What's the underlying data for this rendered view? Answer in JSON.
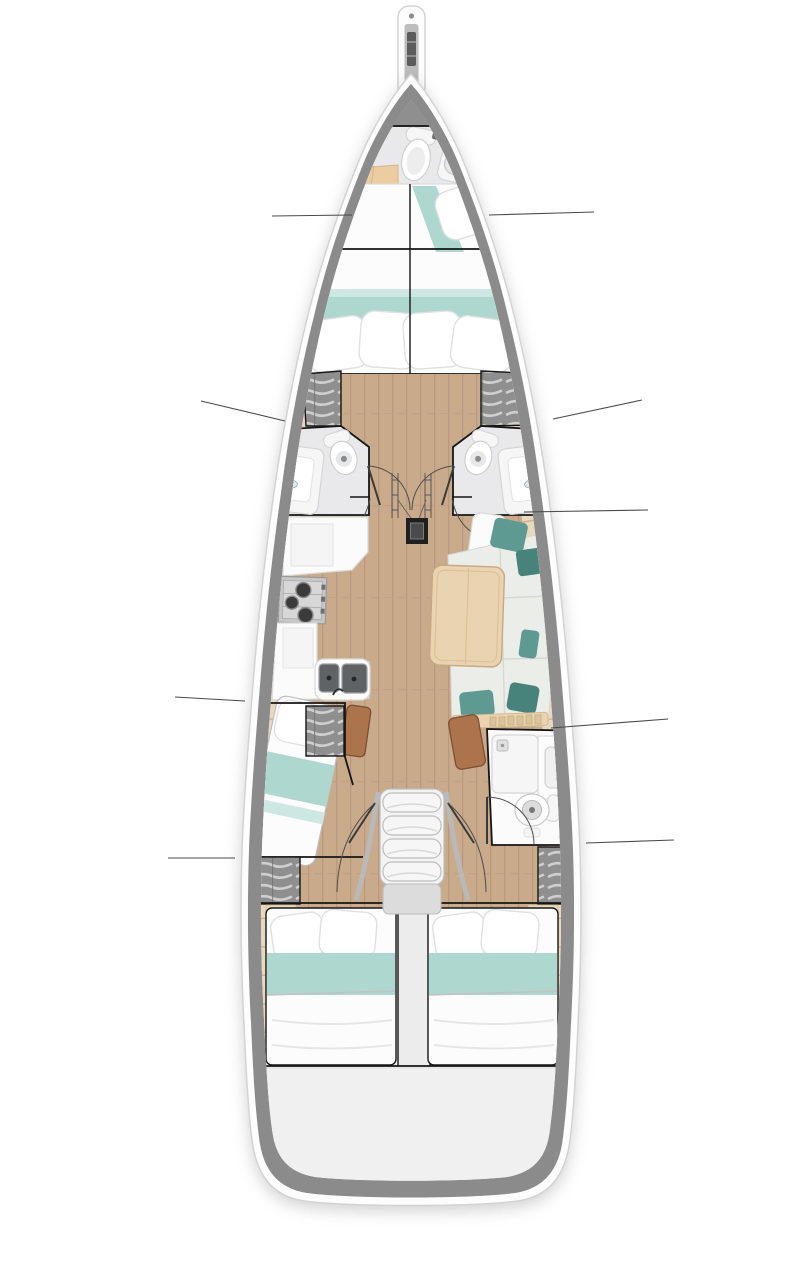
{
  "page": {
    "title": "Sailing yacht interior layout plan, bow up"
  },
  "diagram": {
    "type": "yacht-interior-floor-plan",
    "view": "top-down plan",
    "orientation": "bow at top, stern at bottom",
    "visible_text": "none"
  },
  "colors": {
    "background": "#ffffff",
    "hull_white": "#fdfdfd",
    "hull_edge": "#d3d3d3",
    "gunwale_grey": "#8b8b8b",
    "deck_grey": "#9b9b9b",
    "interior_base": "#f1f1f0",
    "floor_wood": "#c9aa8b",
    "floor_wood_dark": "#b6957a",
    "side_deck": "#e9d9bc",
    "side_deck_seam": "#cdb48e",
    "outline_black": "#161616",
    "leader_grey": "#4a4a4a",
    "bed_white": "#fcfcfc",
    "bed_shadow": "#e4e4e4",
    "blanket_teal": "#aed7d0",
    "blanket_teal_light": "#cde8e3",
    "pillow_white": "#ffffff",
    "pillow_edge": "#e0e0e0",
    "cushion_grey": "#ebede9",
    "cushion_seam": "#d6d8d3",
    "pillow_teal": "#5f9a92",
    "pillow_teal_dark": "#47837b",
    "table_wood": "#ead3b0",
    "table_edge": "#c9a87e",
    "counter_white": "#fbfbfb",
    "counter_edge": "#d9d9d9",
    "steel_grey": "#c7c7c7",
    "basin_dark": "#5f6366",
    "locker_grey": "#8f8f8f",
    "locker_stripe": "#d6d6d6",
    "fixture_white": "#f6f6f7",
    "fixture_edge": "#d5d5d7",
    "head_floor": "#e9e9eb",
    "seat_brown": "#ab744d",
    "seat_brown_dark": "#7c4e33",
    "mast_black": "#1f1f1f",
    "transom_grey": "#f0f0f1",
    "step_grey": "#f3f3f3",
    "step_edge": "#bdbdbd",
    "rail_grey": "#b9b9b9",
    "shower_label": "#dfe9f5",
    "shower_label_edge": "#9ab0d0"
  },
  "compartments": [
    {
      "id": "bowsprit",
      "name": "Bowsprit with anchor roller"
    },
    {
      "id": "forward-head",
      "name": "Forward head with marine toilet and washbasin"
    },
    {
      "id": "forward-cabin",
      "name": "Forward cabin with V-berth double bed"
    },
    {
      "id": "port-head",
      "name": "Port midship head with toilet and shower"
    },
    {
      "id": "starboard-head",
      "name": "Starboard midship head with toilet and shower"
    },
    {
      "id": "galley",
      "name": "Port galley with 3-burner stove, double sink and counters"
    },
    {
      "id": "salon",
      "name": "Starboard salon with settee cushions and dining table"
    },
    {
      "id": "mast-post",
      "name": "Mast compression post"
    },
    {
      "id": "port-cabin",
      "name": "Port single-berth cabin"
    },
    {
      "id": "aft-head",
      "name": "Starboard aft head with shower, washbasin and toilet"
    },
    {
      "id": "companionway",
      "name": "Companionway steps to cockpit"
    },
    {
      "id": "port-aft-cabin",
      "name": "Port aft double cabin"
    },
    {
      "id": "starboard-aft-cabin",
      "name": "Starboard aft double cabin"
    },
    {
      "id": "transom",
      "name": "Stern transom platform"
    }
  ],
  "fixtures": [
    "anchor-roller",
    "marine-toilet",
    "washbasin",
    "shower-tray",
    "storage-locker-shelves",
    "three-burner-stove",
    "double-galley-sink",
    "dining-table",
    "settee-cushions",
    "teal-throw-pillows",
    "mast-compression-post",
    "companionway-steps",
    "handrails",
    "double-berth",
    "single-berth",
    "v-berth"
  ],
  "callouts": {
    "style": "thin unlabeled leader lines",
    "count": 9,
    "lines": [
      {
        "side": "port",
        "target": "forward-cabin"
      },
      {
        "side": "starboard",
        "target": "forward-cabin"
      },
      {
        "side": "port",
        "target": "port-head"
      },
      {
        "side": "starboard",
        "target": "starboard-head"
      },
      {
        "side": "starboard",
        "target": "salon"
      },
      {
        "side": "port",
        "target": "port-cabin"
      },
      {
        "side": "starboard",
        "target": "aft-head"
      },
      {
        "side": "port",
        "target": "port-aft-cabin"
      },
      {
        "side": "starboard",
        "target": "starboard-aft-cabin"
      }
    ]
  }
}
